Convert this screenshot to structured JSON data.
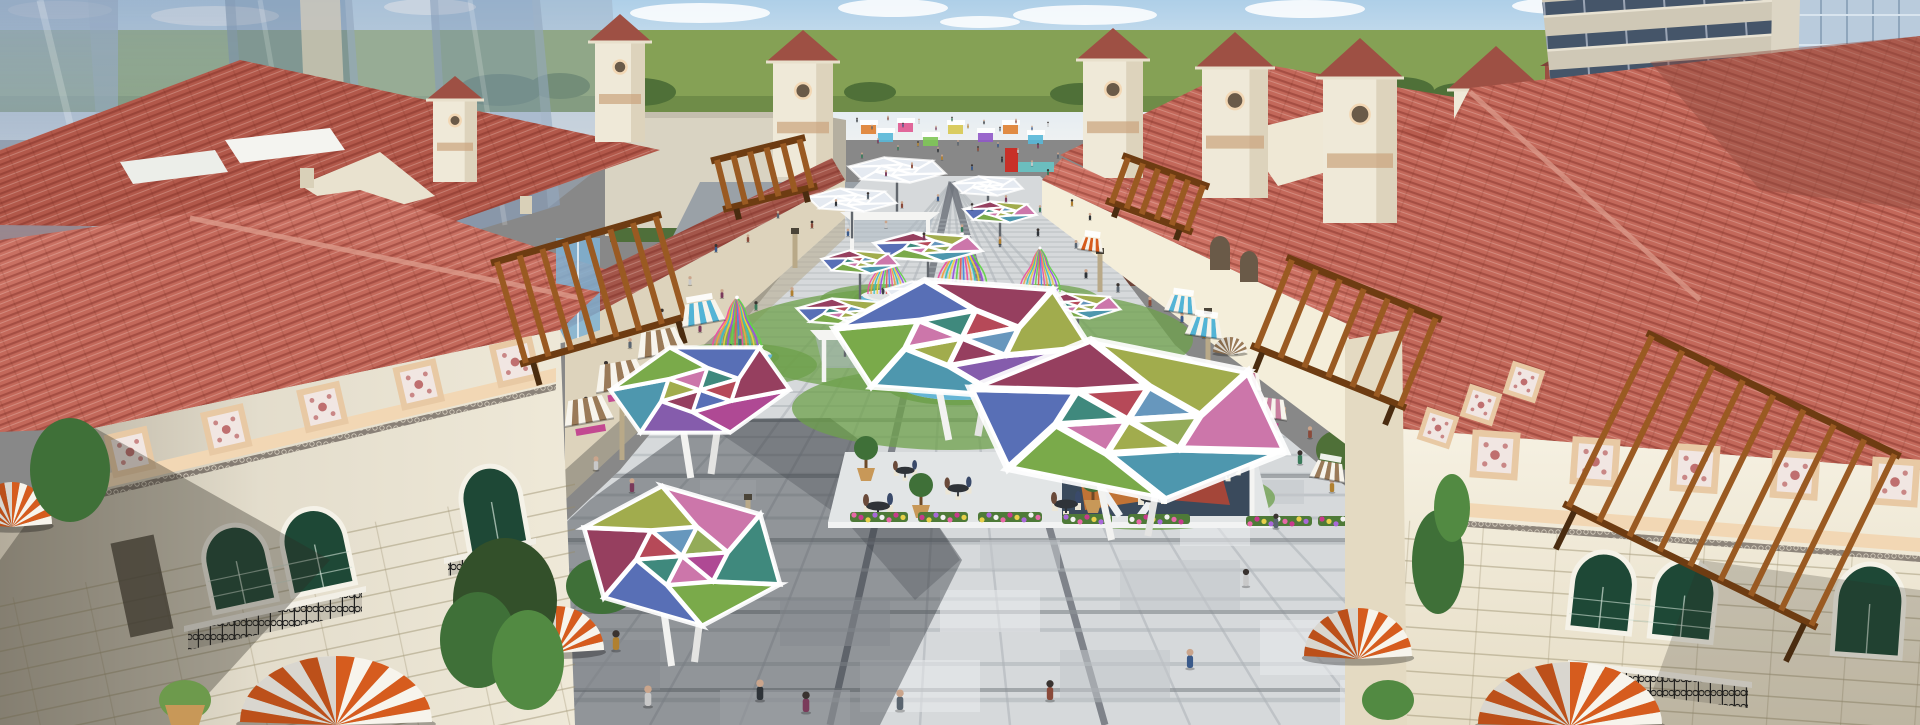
{
  "scene": {
    "kind": "architectural-3d-render",
    "subject": "aerial-view-mediterranean-shopping-plaza",
    "palette": {
      "skyTop": "#aecfe8",
      "skyMid": "#dde9f1",
      "skyLow": "#eef1f2",
      "cloud": "#ffffff",
      "grass": "#85a155",
      "grassDark": "#5f7d3e",
      "tree": "#4f7038",
      "treeLight": "#6d9a4c",
      "treeDark": "#33502a",
      "glass1": "#93a7c0",
      "glass2": "#a9bacd",
      "glass3": "#7d93ae",
      "glassPane": "#b9cbdc",
      "glassLine": "#8fa6bc",
      "towerBeige": "#cfc8b6",
      "towerBand": "#455569",
      "brick": "#a15b4b",
      "brickDark": "#7e4438",
      "roof": "#c3685a",
      "roofLight": "#d4887a",
      "roofDark": "#9e5044",
      "roofShadow": "#7e4038",
      "roofRidge": "#dc9a8a",
      "wall": "#efe9d8",
      "wallLit": "#f6f1e2",
      "wallShade": "#ddd3bc",
      "wallTan": "#cfc3a4",
      "cornice": "#f2d7b4",
      "corniceDark": "#caa27c",
      "ornFrame": "#e8c9a4",
      "ornFill": "#f1e6e2",
      "ornMotif": "#bf6f6f",
      "winGreen": "#1e4836",
      "winFrame": "#f5f2e8",
      "iron": "#232323",
      "paveLight": "#d6d9db",
      "paveMid": "#c2c7ca",
      "paveDark": "#a9aeb2",
      "paveWhite": "#e9ebec",
      "paveStrip": "#70757d",
      "paveLine": "#b6bbbf",
      "shadow": "#2e3338",
      "roadGray": "#9aa1a7",
      "awnOrange": "#d65c1e",
      "awnWhite": "#f7f4ec",
      "awnBlue": "#53b4d6",
      "awnBrown": "#9a7a58",
      "awnPink": "#c97f9f",
      "pergola": "#9a5a22",
      "pergolaDark": "#6e3c12",
      "lawn": "#6da04b",
      "benchBlue": "#55aed2",
      "water": "#66c8c8",
      "kioskGlass": "#3a4a5c",
      "kioskArt1": "#d97a2e",
      "kioskArt2": "#c8452e",
      "sign": "#c03a8c",
      "potTan": "#c89858",
      "skinTone": "#caa58c"
    },
    "clouds": [
      [
        60,
        10,
        52,
        9
      ],
      [
        215,
        16,
        64,
        10
      ],
      [
        430,
        7,
        46,
        8
      ],
      [
        700,
        13,
        70,
        10
      ],
      [
        893,
        8,
        55,
        9
      ],
      [
        1085,
        15,
        72,
        10
      ],
      [
        1305,
        9,
        60,
        9
      ],
      [
        1560,
        6,
        48,
        8
      ],
      [
        1770,
        13,
        80,
        12
      ],
      [
        980,
        22,
        40,
        6
      ],
      [
        1680,
        24,
        44,
        7
      ]
    ],
    "bg_trees": [
      [
        500,
        90,
        42,
        16
      ],
      [
        560,
        86,
        30,
        13
      ],
      [
        640,
        92,
        36,
        14
      ],
      [
        870,
        92,
        26,
        10
      ],
      [
        1080,
        94,
        30,
        11
      ],
      [
        1400,
        90,
        34,
        13
      ],
      [
        1460,
        94,
        28,
        11
      ],
      [
        150,
        305,
        48,
        34
      ],
      [
        262,
        288,
        40,
        30
      ],
      [
        365,
        272,
        36,
        28
      ],
      [
        480,
        300,
        44,
        32
      ],
      [
        1545,
        420,
        70,
        55
      ],
      [
        1472,
        442,
        42,
        36
      ],
      [
        1402,
        432,
        28,
        24
      ],
      [
        1340,
        450,
        24,
        20
      ]
    ],
    "towers": [
      [
        455,
        100,
        44,
        82,
        24
      ],
      [
        620,
        42,
        50,
        100,
        28
      ],
      [
        803,
        62,
        60,
        115,
        32
      ],
      [
        1113,
        60,
        60,
        118,
        32
      ],
      [
        1235,
        68,
        66,
        130,
        36
      ],
      [
        1360,
        78,
        74,
        145,
        40
      ],
      [
        1496,
        90,
        84,
        160,
        44
      ]
    ],
    "floor": {
      "long_xs": [
        470,
        560,
        650,
        740,
        920,
        1010,
        1190,
        1280,
        1370,
        1460
      ],
      "strong_xs": [
        830,
        1105
      ],
      "cross_ys": [
        700,
        664,
        630,
        599,
        570,
        543,
        518,
        495,
        474,
        455,
        437,
        421,
        406,
        392,
        379,
        367,
        356,
        346,
        337,
        328,
        320,
        312,
        305,
        298,
        291,
        285,
        279,
        273,
        267,
        262,
        257,
        252,
        247,
        242,
        237,
        232,
        228,
        224,
        220
      ],
      "band_ys": [
        690,
        612,
        540,
        476,
        420
      ],
      "vp": [
        952,
        182
      ],
      "slabs": [
        [
          640,
          560,
          90,
          40,
          0
        ],
        [
          780,
          600,
          110,
          46,
          1
        ],
        [
          940,
          590,
          100,
          42,
          0
        ],
        [
          1120,
          560,
          120,
          50,
          1
        ],
        [
          1260,
          620,
          130,
          55,
          0
        ],
        [
          560,
          640,
          100,
          50,
          1
        ],
        [
          860,
          660,
          120,
          52,
          0
        ],
        [
          1060,
          650,
          110,
          48,
          1
        ],
        [
          1340,
          680,
          140,
          45,
          0
        ],
        [
          720,
          690,
          130,
          35,
          0
        ],
        [
          980,
          540,
          80,
          30,
          1
        ],
        [
          1180,
          520,
          70,
          26,
          0
        ],
        [
          830,
          500,
          60,
          22,
          1
        ],
        [
          700,
          480,
          56,
          20,
          0
        ],
        [
          1240,
          480,
          64,
          24,
          1
        ],
        [
          1420,
          640,
          90,
          40,
          0
        ]
      ]
    },
    "lawns": [
      [
        958,
        340,
        235,
        55
      ],
      [
        952,
        408,
        160,
        42
      ],
      [
        1150,
        498,
        125,
        32
      ],
      [
        735,
        365,
        82,
        22
      ],
      [
        880,
        300,
        60,
        16
      ],
      [
        1040,
        300,
        60,
        16
      ]
    ],
    "canopy_panel_colors": [
      "#a93a8c",
      "#7b4fa6",
      "#3f8fa8",
      "#6fa33b",
      "#4a63b0",
      "#8e2f52",
      "#9aa63e",
      "#c86ba3",
      "#2f7f72",
      "#b03a4a",
      "#5b8fb8",
      "#8aa44a"
    ],
    "cage_colors": [
      "#ec4fa0",
      "#f0a43c",
      "#37c1c1",
      "#ead23c",
      "#9a4fe0",
      "#63d44a",
      "#e05a5a",
      "#4a8ae0"
    ],
    "big_canopies": [
      [
        700,
        390,
        92,
        48,
        -8,
        0
      ],
      [
        682,
        556,
        104,
        70,
        6,
        3
      ],
      [
        962,
        338,
        132,
        62,
        -3,
        1
      ],
      [
        1128,
        420,
        165,
        80,
        4,
        2
      ]
    ],
    "umbrellas": [
      [
        897,
        170,
        50,
        13,
        0
      ],
      [
        988,
        186,
        36,
        10,
        0
      ],
      [
        852,
        200,
        46,
        12,
        0
      ],
      [
        1000,
        212,
        38,
        11,
        1
      ],
      [
        928,
        247,
        56,
        15,
        1
      ],
      [
        860,
        262,
        40,
        12,
        1
      ],
      [
        845,
        312,
        50,
        14,
        1
      ],
      [
        1078,
        306,
        44,
        13,
        1
      ],
      [
        922,
        292,
        38,
        11,
        0
      ]
    ],
    "cages": [
      [
        888,
        294,
        0.5
      ],
      [
        962,
        288,
        0.62
      ],
      [
        1040,
        292,
        0.5
      ],
      [
        737,
        352,
        0.62
      ],
      [
        958,
        378,
        1.05
      ],
      [
        1152,
        470,
        1.15
      ]
    ],
    "domes": [
      [
        336,
        722,
        96,
        66,
        0
      ],
      [
        556,
        650,
        48,
        44,
        0
      ],
      [
        12,
        524,
        40,
        42,
        0
      ],
      [
        1358,
        656,
        54,
        48,
        0
      ],
      [
        1570,
        724,
        92,
        62,
        0
      ],
      [
        1230,
        352,
        17,
        15,
        1
      ]
    ],
    "awnings": [
      [
        700,
        302,
        44,
        "awnBlue",
        -10,
        0
      ],
      [
        658,
        330,
        50,
        "awnBrown",
        -10,
        1
      ],
      [
        618,
        362,
        54,
        "awnBrown",
        -10,
        1
      ],
      [
        652,
        386,
        46,
        "awnBlue",
        -8,
        0
      ],
      [
        585,
        398,
        50,
        "awnBrown",
        -10,
        1
      ],
      [
        1183,
        296,
        34,
        "awnBlue",
        8,
        0
      ],
      [
        1206,
        318,
        38,
        "awnBlue",
        8,
        0
      ],
      [
        1247,
        372,
        34,
        "awnPink",
        8,
        1
      ],
      [
        1270,
        398,
        40,
        "awnPink",
        8,
        1
      ],
      [
        1092,
        238,
        26,
        "awnOrange",
        8,
        0
      ],
      [
        1330,
        462,
        36,
        "awnBrown",
        10,
        0
      ]
    ],
    "pergolas": [
      [
        497,
        262,
        165,
        105,
        -16,
        8
      ],
      [
        717,
        160,
        85,
        50,
        -14,
        6
      ],
      [
        1292,
        260,
        155,
        95,
        22,
        7
      ],
      [
        1652,
        336,
        270,
        190,
        26,
        9
      ],
      [
        1128,
        158,
        80,
        48,
        20,
        6
      ]
    ],
    "ornament_rows": [
      {
        "x1": 130,
        "y1": 452,
        "x2": 515,
        "y2": 362,
        "n": 5,
        "size": 44,
        "rot": -13
      },
      {
        "x1": 1495,
        "y1": 455,
        "x2": 1895,
        "y2": 482,
        "n": 5,
        "size": 48,
        "rot": 4
      },
      {
        "x1": 1438,
        "y1": 428,
        "x2": 1524,
        "y2": 382,
        "n": 3,
        "size": 34,
        "rot": 18
      }
    ],
    "stalls": [
      [
        868,
        128,
        "#e08030"
      ],
      [
        885,
        136,
        "#58b8d8"
      ],
      [
        905,
        126,
        "#e05890"
      ],
      [
        930,
        140,
        "#80c858"
      ],
      [
        955,
        128,
        "#d8c850"
      ],
      [
        985,
        136,
        "#9058c8"
      ],
      [
        1010,
        128,
        "#e08030"
      ],
      [
        1035,
        138,
        "#58b8d8"
      ]
    ],
    "posts": [
      [
        622,
        400,
        60
      ],
      [
        748,
        498,
        55
      ],
      [
        795,
        232,
        36
      ],
      [
        1100,
        252,
        40
      ],
      [
        1208,
        312,
        55
      ]
    ],
    "cafe_tables": [
      [
        905,
        472,
        0.8
      ],
      [
        958,
        490,
        0.9
      ],
      [
        1042,
        470,
        0.8
      ],
      [
        1066,
        506,
        1.0
      ],
      [
        1152,
        500,
        1.0
      ],
      [
        1228,
        472,
        0.85
      ],
      [
        878,
        508,
        1.0
      ]
    ],
    "topiary": [
      [
        921,
        505
      ],
      [
        1093,
        500
      ],
      [
        866,
        468
      ]
    ],
    "flowers": [
      [
        850,
        512,
        58
      ],
      [
        918,
        512,
        50
      ],
      [
        978,
        512,
        64
      ],
      [
        1062,
        514,
        50
      ],
      [
        1128,
        514,
        62
      ],
      [
        1246,
        516,
        66
      ],
      [
        1318,
        516,
        70
      ],
      [
        1392,
        518,
        46
      ]
    ],
    "flower_colors": [
      "#e868a8",
      "#c83a8c",
      "#e8d04a",
      "#a868d8",
      "#f2f2f2"
    ],
    "cars": [
      [
        870,
        196,
        20,
        9,
        "#d0d4d8"
      ],
      [
        915,
        191,
        16,
        7,
        "#3f464e"
      ],
      [
        1060,
        198,
        22,
        9,
        "#8a4038"
      ]
    ],
    "people_colors": [
      "#2e3338",
      "#5a6570",
      "#8a4a3a",
      "#3a5a8a",
      "#c8c8c8",
      "#7a3a5a",
      "#3a7a5a",
      "#b08030"
    ],
    "people": [
      [
        857,
        122,
        0.32
      ],
      [
        872,
        129,
        0.32
      ],
      [
        888,
        120,
        0.32
      ],
      [
        903,
        127,
        0.32
      ],
      [
        919,
        123,
        0.32
      ],
      [
        936,
        130,
        0.32
      ],
      [
        952,
        121,
        0.32
      ],
      [
        968,
        128,
        0.32
      ],
      [
        984,
        124,
        0.32
      ],
      [
        1000,
        131,
        0.32
      ],
      [
        1016,
        123,
        0.32
      ],
      [
        1032,
        130,
        0.32
      ],
      [
        1048,
        126,
        0.32
      ],
      [
        878,
        143,
        0.36
      ],
      [
        898,
        150,
        0.36
      ],
      [
        918,
        146,
        0.36
      ],
      [
        938,
        152,
        0.36
      ],
      [
        958,
        145,
        0.36
      ],
      [
        978,
        151,
        0.36
      ],
      [
        998,
        147,
        0.36
      ],
      [
        1018,
        153,
        0.36
      ],
      [
        1038,
        148,
        0.36
      ],
      [
        862,
        158,
        0.4
      ],
      [
        942,
        160,
        0.4
      ],
      [
        1002,
        162,
        0.4
      ],
      [
        1058,
        158,
        0.4
      ],
      [
        912,
        168,
        0.42
      ],
      [
        972,
        170,
        0.42
      ],
      [
        1032,
        166,
        0.42
      ],
      [
        886,
        176,
        0.44
      ],
      [
        1048,
        175,
        0.44
      ],
      [
        806,
        196,
        0.5
      ],
      [
        836,
        206,
        0.5
      ],
      [
        868,
        199,
        0.5
      ],
      [
        902,
        208,
        0.5
      ],
      [
        938,
        201,
        0.5
      ],
      [
        972,
        210,
        0.5
      ],
      [
        1006,
        202,
        0.5
      ],
      [
        1040,
        212,
        0.5
      ],
      [
        1072,
        206,
        0.5
      ],
      [
        1090,
        220,
        0.52
      ],
      [
        778,
        218,
        0.52
      ],
      [
        812,
        228,
        0.54
      ],
      [
        848,
        236,
        0.54
      ],
      [
        886,
        228,
        0.54
      ],
      [
        924,
        240,
        0.56
      ],
      [
        962,
        232,
        0.56
      ],
      [
        1000,
        244,
        0.56
      ],
      [
        1038,
        236,
        0.56
      ],
      [
        1076,
        248,
        0.58
      ],
      [
        748,
        242,
        0.56
      ],
      [
        716,
        252,
        0.58
      ],
      [
        690,
        285,
        0.65
      ],
      [
        722,
        298,
        0.65
      ],
      [
        756,
        310,
        0.65
      ],
      [
        792,
        296,
        0.65
      ],
      [
        1086,
        278,
        0.65
      ],
      [
        1118,
        292,
        0.65
      ],
      [
        1150,
        306,
        0.68
      ],
      [
        1182,
        322,
        0.68
      ],
      [
        662,
        318,
        0.68
      ],
      [
        700,
        332,
        0.7
      ],
      [
        740,
        345,
        0.7
      ],
      [
        1204,
        338,
        0.7
      ],
      [
        1236,
        354,
        0.72
      ],
      [
        630,
        348,
        0.72
      ],
      [
        606,
        372,
        0.8
      ],
      [
        640,
        388,
        0.8
      ],
      [
        676,
        404,
        0.82
      ],
      [
        1218,
        376,
        0.8
      ],
      [
        1252,
        396,
        0.82
      ],
      [
        1284,
        418,
        0.84
      ],
      [
        586,
        408,
        0.82
      ],
      [
        712,
        420,
        0.84
      ],
      [
        1310,
        438,
        0.86
      ],
      [
        558,
        448,
        1.0
      ],
      [
        596,
        470,
        1.0
      ],
      [
        632,
        492,
        1.0
      ],
      [
        1300,
        464,
        1.0
      ],
      [
        1332,
        492,
        1.0
      ],
      [
        668,
        520,
        1.05
      ],
      [
        1276,
        528,
        1.05
      ],
      [
        540,
        560,
        1.25
      ],
      [
        608,
        596,
        1.25
      ],
      [
        1246,
        586,
        1.25
      ],
      [
        700,
        560,
        1.2
      ],
      [
        508,
        588,
        1.4
      ],
      [
        616,
        650,
        1.45
      ],
      [
        760,
        700,
        1.5
      ],
      [
        900,
        710,
        1.5
      ],
      [
        1050,
        700,
        1.45
      ],
      [
        1190,
        668,
        1.4
      ],
      [
        648,
        706,
        1.5
      ],
      [
        806,
        712,
        1.5
      ]
    ]
  }
}
